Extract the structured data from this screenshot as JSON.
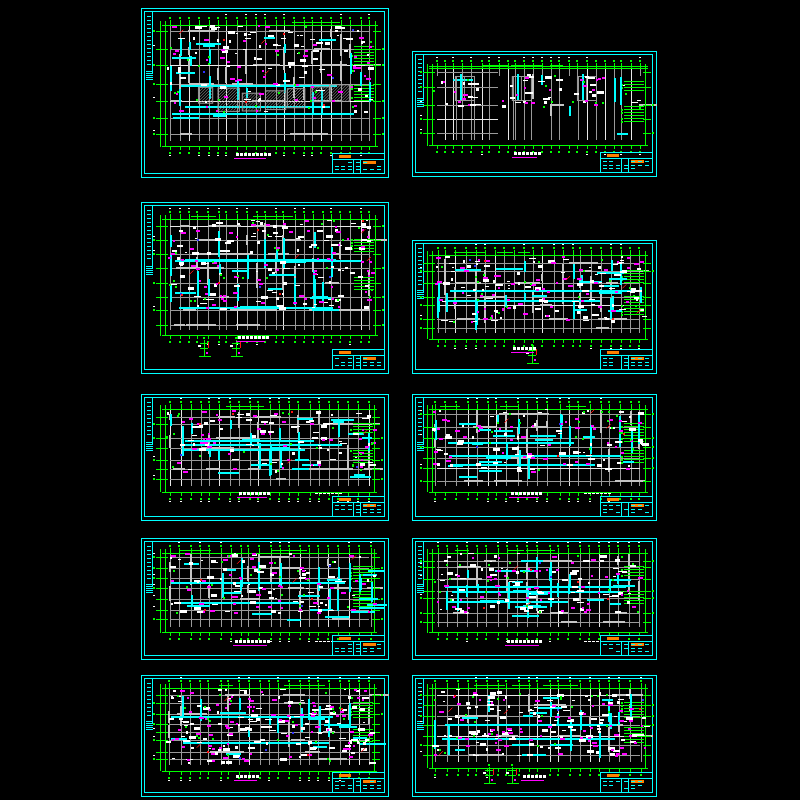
{
  "meta": {
    "description": "Preview collage of ten structural-engineering CAD drawing sheets (beam / slab reinforcement framing plans) on a black model-space background",
    "sheet_count": 10,
    "legible_text": ""
  },
  "colors": {
    "background": "#000000",
    "frame": "#00ffff",
    "grid": "#9a9a9a",
    "grid_bright": "#e8e8e8",
    "wall": "#c4c4c4",
    "beam": "#00ffff",
    "dim": "#00ff00",
    "annotation": "#ff00ff",
    "text": "#ffffff",
    "accent": "#ff8000",
    "danger": "#ff1010",
    "blue": "#3030ff"
  },
  "sheets": [
    {
      "id": "01",
      "x": 141,
      "y": 8,
      "w": 248,
      "h": 170,
      "seed": 11,
      "plan": [
        0.117,
        0.1,
        0.923,
        0.78
      ],
      "vgrid": 22,
      "hgrid": 7,
      "walls": 34,
      "beams_v": 16,
      "beams_h": 8,
      "main_beams": 3,
      "hatch": 7,
      "white": 85,
      "magenta": 50,
      "red": 7,
      "green": 22,
      "blue": 3,
      "sparse": false,
      "right_comb": true,
      "clusters": [],
      "details": [],
      "band": [
        0.0,
        0.75
      ],
      "title_x": 0.45,
      "title_y": 0.85,
      "title_w": 34,
      "side_text": false
    },
    {
      "id": "02",
      "x": 412,
      "y": 51,
      "w": 245,
      "h": 126,
      "seed": 22,
      "plan": [
        0.1,
        0.135,
        0.93,
        0.71
      ],
      "vgrid": 24,
      "hgrid": 5,
      "walls": 4,
      "beams_v": 4,
      "beams_h": 2,
      "main_beams": 0,
      "hatch": 0,
      "white": 26,
      "magenta": 12,
      "red": 0,
      "green": 12,
      "blue": 0,
      "sparse": true,
      "right_comb": true,
      "clusters": [
        0.14,
        0.42,
        0.74
      ],
      "details": [],
      "band": [
        0.05,
        0.55
      ],
      "title_x": 0.47,
      "title_y": 0.8,
      "title_w": 26,
      "side_text": false
    },
    {
      "id": "03",
      "x": 141,
      "y": 202,
      "w": 248,
      "h": 172,
      "seed": 33,
      "plan": [
        0.117,
        0.1,
        0.923,
        0.745
      ],
      "vgrid": 22,
      "hgrid": 8,
      "walls": 40,
      "beams_v": 18,
      "beams_h": 12,
      "main_beams": 3,
      "hatch": 0,
      "white": 105,
      "magenta": 66,
      "red": 9,
      "green": 26,
      "blue": 4,
      "sparse": false,
      "right_comb": true,
      "clusters": [],
      "details": [
        [
          0.17,
          0.885
        ],
        [
          0.33,
          0.885
        ]
      ],
      "band": [
        0.0,
        0.8
      ],
      "title_x": 0.45,
      "title_y": 0.78,
      "title_w": 30,
      "side_text": false
    },
    {
      "id": "04",
      "x": 412,
      "y": 240,
      "w": 245,
      "h": 134,
      "seed": 44,
      "plan": [
        0.1,
        0.115,
        0.93,
        0.7
      ],
      "vgrid": 22,
      "hgrid": 7,
      "walls": 34,
      "beams_v": 16,
      "beams_h": 10,
      "main_beams": 2,
      "hatch": 0,
      "white": 92,
      "magenta": 58,
      "red": 5,
      "green": 22,
      "blue": 2,
      "sparse": false,
      "right_comb": true,
      "clusters": [],
      "details": [
        [
          0.47,
          0.9
        ]
      ],
      "band": [
        0.0,
        0.85
      ],
      "title_x": 0.46,
      "title_y": 0.8,
      "title_w": 24,
      "side_text": false
    },
    {
      "id": "05",
      "x": 141,
      "y": 394,
      "w": 248,
      "h": 127,
      "seed": 55,
      "plan": [
        0.117,
        0.12,
        0.92,
        0.73
      ],
      "vgrid": 21,
      "hgrid": 7,
      "walls": 26,
      "beams_v": 15,
      "beams_h": 14,
      "main_beams": 3,
      "hatch": 0,
      "white": 66,
      "magenta": 44,
      "red": 5,
      "green": 20,
      "blue": 2,
      "sparse": false,
      "right_comb": true,
      "clusters": [],
      "details": [],
      "band": [
        0.0,
        0.8
      ],
      "title_x": 0.46,
      "title_y": 0.775,
      "title_w": 32,
      "side_text": true
    },
    {
      "id": "06",
      "x": 412,
      "y": 394,
      "w": 245,
      "h": 127,
      "seed": 66,
      "plan": [
        0.1,
        0.12,
        0.93,
        0.73
      ],
      "vgrid": 21,
      "hgrid": 7,
      "walls": 26,
      "beams_v": 15,
      "beams_h": 14,
      "main_beams": 3,
      "hatch": 0,
      "white": 66,
      "magenta": 44,
      "red": 5,
      "green": 20,
      "blue": 2,
      "sparse": false,
      "right_comb": true,
      "clusters": [],
      "details": [],
      "band": [
        0.0,
        0.8
      ],
      "title_x": 0.47,
      "title_y": 0.775,
      "title_w": 32,
      "side_text": true
    },
    {
      "id": "07",
      "x": 141,
      "y": 538,
      "w": 248,
      "h": 122,
      "seed": 77,
      "plan": [
        0.117,
        0.12,
        0.92,
        0.73
      ],
      "vgrid": 21,
      "hgrid": 7,
      "walls": 24,
      "beams_v": 18,
      "beams_h": 16,
      "main_beams": 3,
      "hatch": 0,
      "white": 72,
      "magenta": 48,
      "red": 6,
      "green": 20,
      "blue": 2,
      "sparse": false,
      "right_comb": true,
      "clusters": [],
      "details": [],
      "band": [
        0.0,
        0.8
      ],
      "title_x": 0.45,
      "title_y": 0.835,
      "title_w": 36,
      "side_text": true
    },
    {
      "id": "08",
      "x": 412,
      "y": 538,
      "w": 245,
      "h": 122,
      "seed": 88,
      "plan": [
        0.1,
        0.12,
        0.93,
        0.73
      ],
      "vgrid": 21,
      "hgrid": 7,
      "walls": 24,
      "beams_v": 18,
      "beams_h": 16,
      "main_beams": 3,
      "hatch": 0,
      "white": 72,
      "magenta": 48,
      "red": 6,
      "green": 20,
      "blue": 2,
      "sparse": false,
      "right_comb": true,
      "clusters": [],
      "details": [],
      "band": [
        0.0,
        0.8
      ],
      "title_x": 0.46,
      "title_y": 0.835,
      "title_w": 36,
      "side_text": true
    },
    {
      "id": "09",
      "x": 141,
      "y": 675,
      "w": 248,
      "h": 122,
      "seed": 99,
      "plan": [
        0.117,
        0.11,
        0.92,
        0.745
      ],
      "vgrid": 21,
      "hgrid": 8,
      "walls": 18,
      "beams_v": 12,
      "beams_h": 10,
      "main_beams": 2,
      "hatch": 0,
      "white": 125,
      "magenta": 75,
      "red": 6,
      "green": 26,
      "blue": 3,
      "sparse": false,
      "right_comb": true,
      "clusters": [],
      "details": [],
      "band": [
        0.0,
        0.95
      ],
      "title_x": 0.43,
      "title_y": 0.82,
      "title_w": 24,
      "side_text": false
    },
    {
      "id": "10",
      "x": 412,
      "y": 675,
      "w": 245,
      "h": 122,
      "seed": 110,
      "plan": [
        0.1,
        0.11,
        0.93,
        0.72
      ],
      "vgrid": 21,
      "hgrid": 7,
      "walls": 18,
      "beams_v": 12,
      "beams_h": 10,
      "main_beams": 2,
      "hatch": 0,
      "white": 108,
      "magenta": 62,
      "red": 5,
      "green": 22,
      "blue": 2,
      "sparse": false,
      "right_comb": true,
      "clusters": [],
      "details": [
        [
          0.26,
          0.87
        ],
        [
          0.37,
          0.87
        ]
      ],
      "band": [
        0.0,
        0.9
      ],
      "title_x": 0.5,
      "title_y": 0.82,
      "title_w": 24,
      "side_text": false
    }
  ]
}
